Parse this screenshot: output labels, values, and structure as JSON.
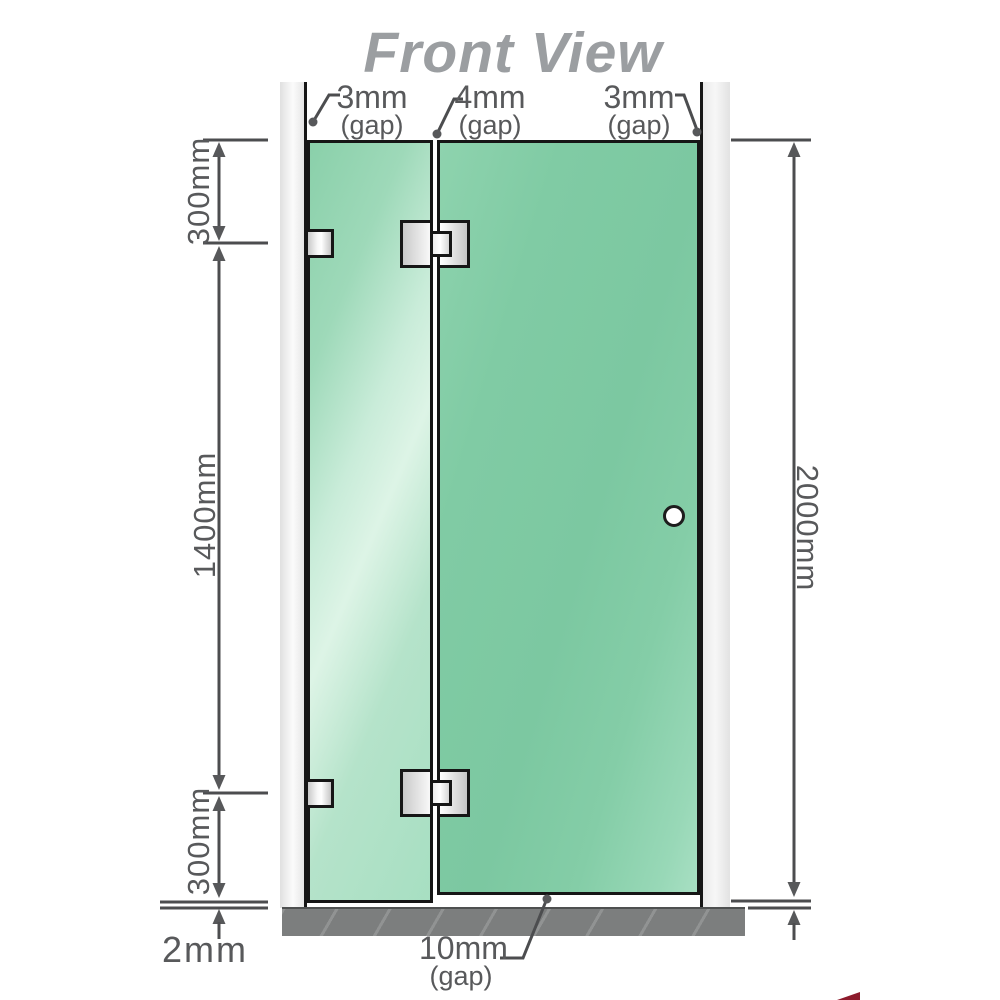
{
  "title": "Front View",
  "dimensions": {
    "segment_top": "300mm",
    "segment_middle": "1400mm",
    "segment_bottom": "300mm",
    "base_clearance": "2mm",
    "total_height": "2000mm"
  },
  "gaps": {
    "left": {
      "value": "3mm",
      "label": "(gap)"
    },
    "middle": {
      "value": "4mm",
      "label": "(gap)"
    },
    "right": {
      "value": "3mm",
      "label": "(gap)"
    },
    "bottom": {
      "value": "10mm",
      "label": "(gap)"
    }
  },
  "colors": {
    "glass_green": "#7fc9a3",
    "glass_light": "#d9f2e4",
    "wall_gray": "#ececec",
    "base_gray": "#7c7e7e",
    "outline_black": "#161616",
    "dimension_gray": "#4c4d4f",
    "title_gray": "#9b9ea1",
    "accent_red": "#8d1b2c"
  }
}
